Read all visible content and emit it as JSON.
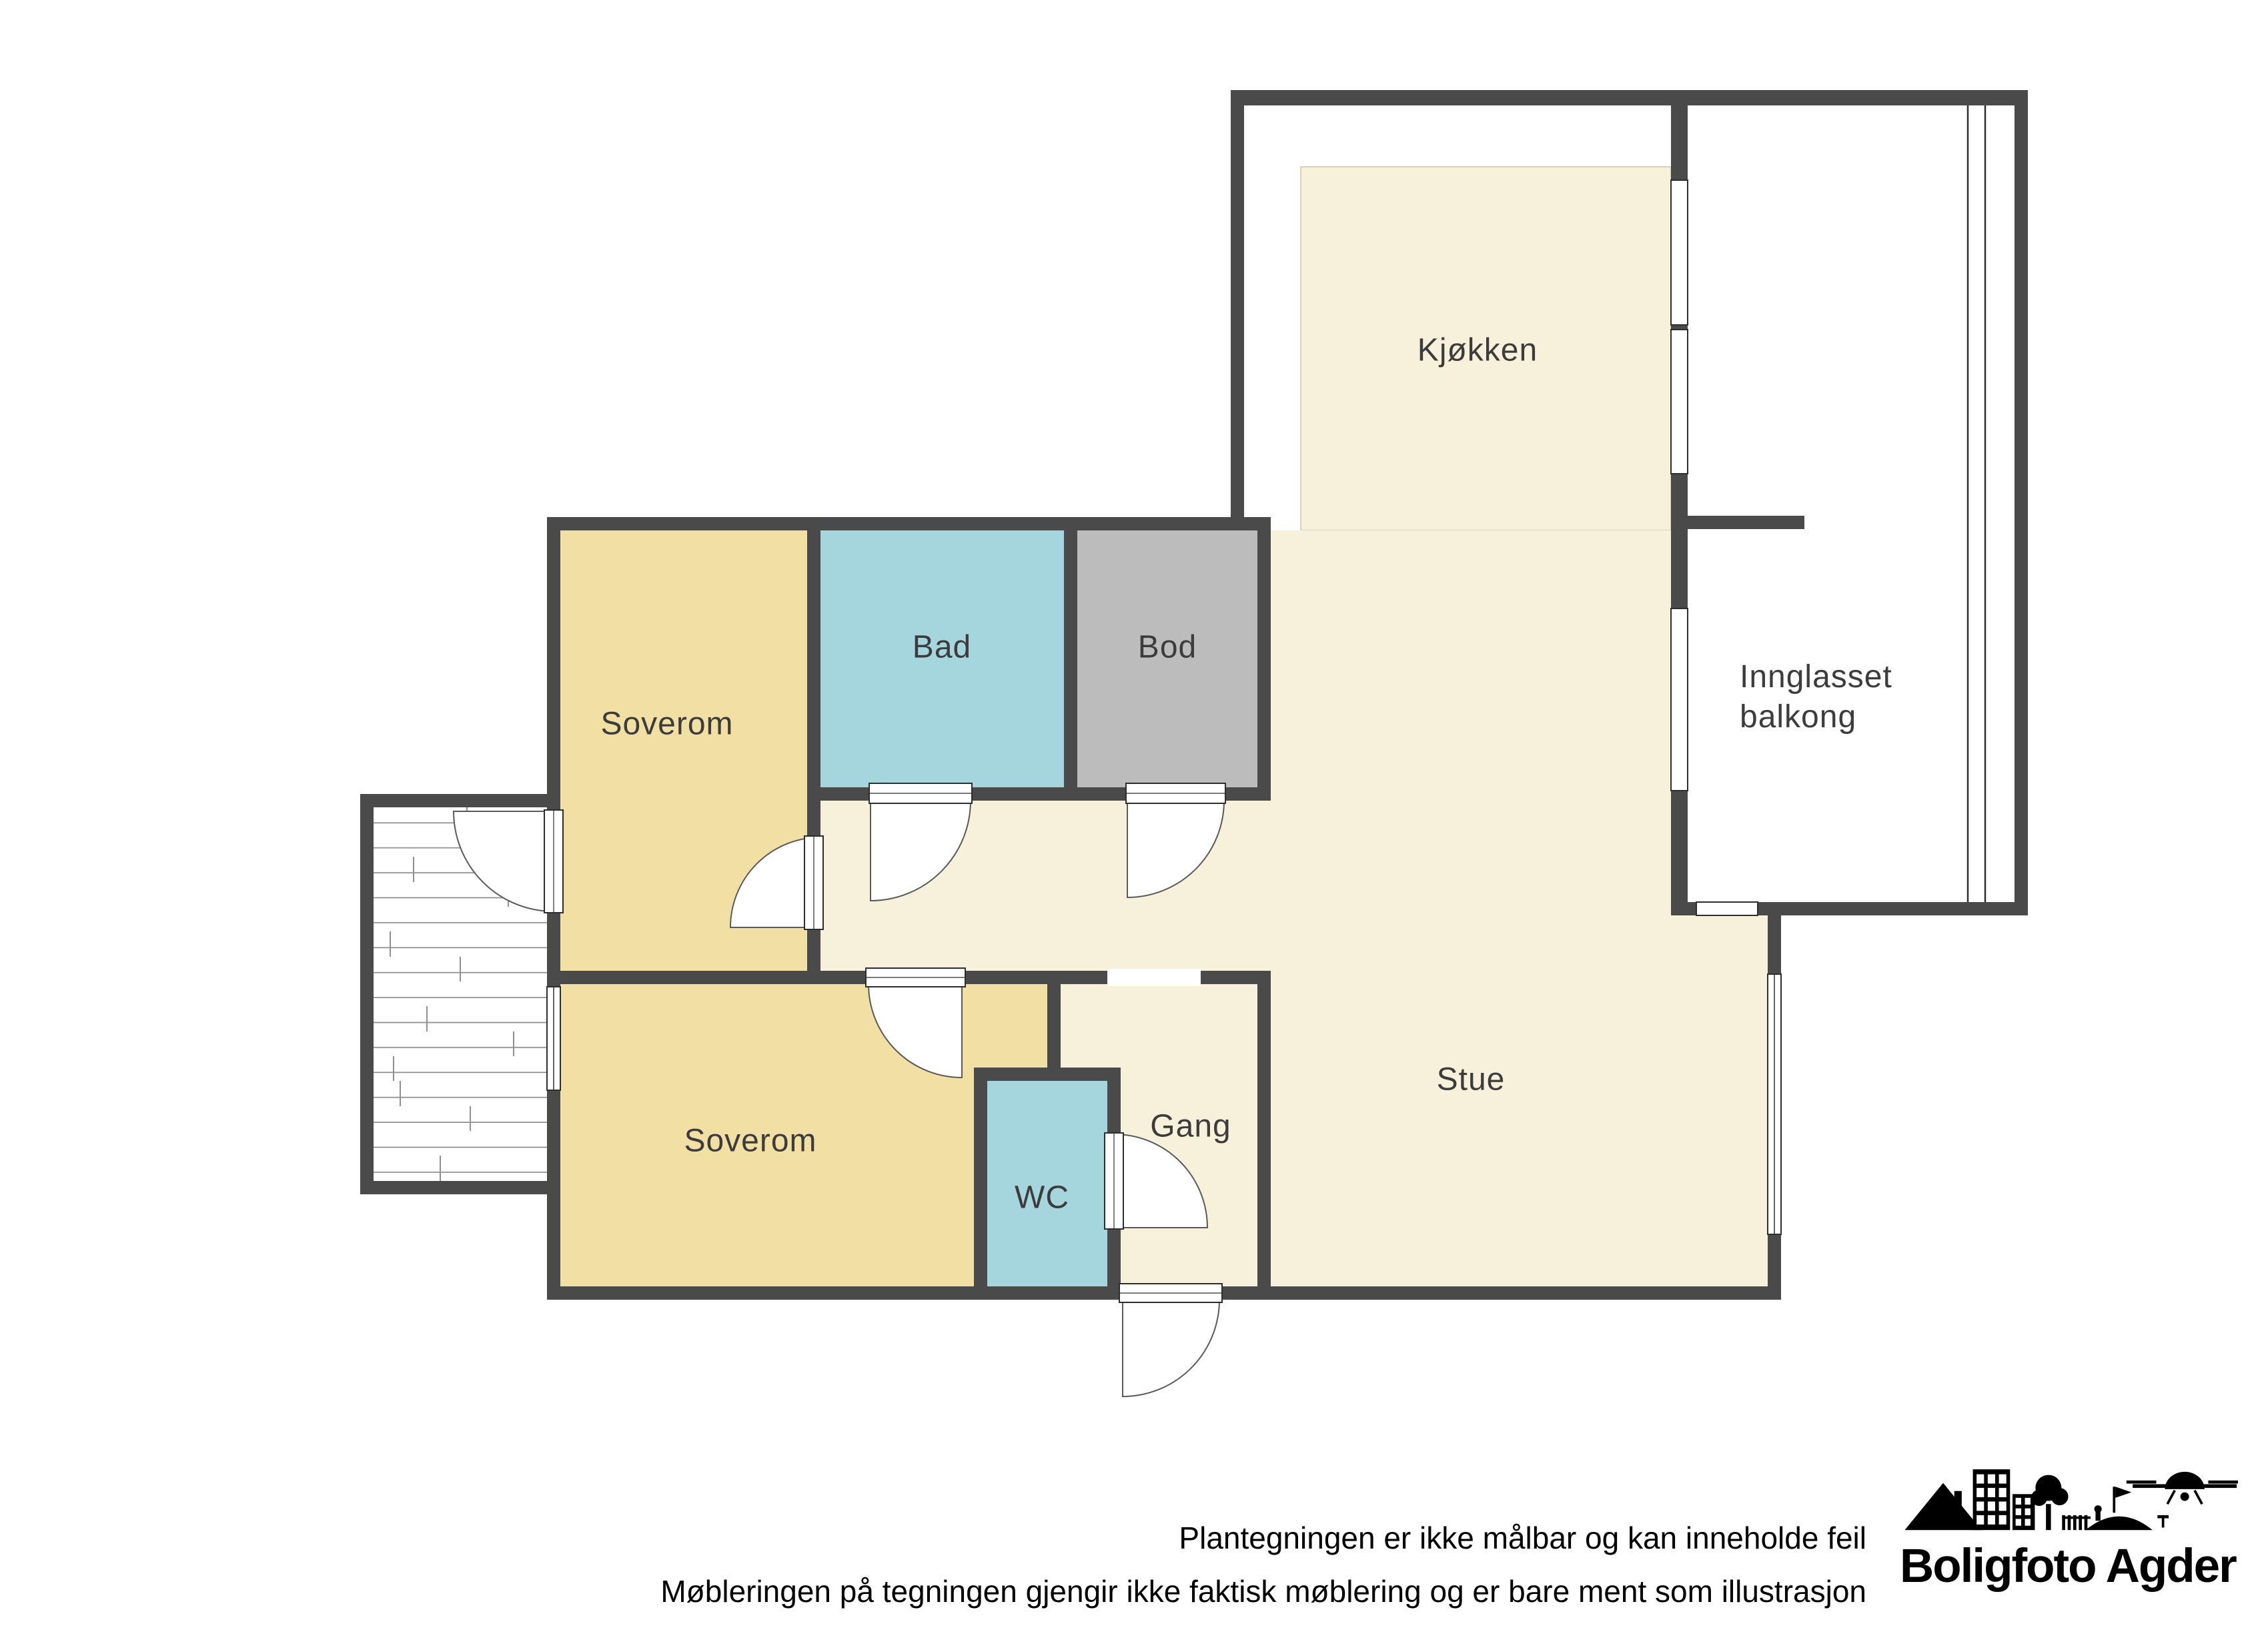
{
  "plan": {
    "title_hint": "apartment floor plan",
    "wall_color": "#4a4a4a",
    "floor_cream": "#f7f1dc",
    "bedroom_yellow": "#f1dfa3",
    "bath_blue": "#a5d6de",
    "storage_gray": "#bcbcbc",
    "rooms": [
      {
        "id": "kjokken",
        "label": "Kjøkken",
        "color": "#f7f1dc"
      },
      {
        "id": "innglasset-balkong",
        "label": "Innglasset balkong",
        "line1": "Innglasset",
        "line2": "balkong",
        "color": "#ffffff"
      },
      {
        "id": "soverom-1",
        "label": "Soverom",
        "color": "#f1dfa3"
      },
      {
        "id": "bad",
        "label": "Bad",
        "color": "#a5d6de"
      },
      {
        "id": "bod",
        "label": "Bod",
        "color": "#bcbcbc"
      },
      {
        "id": "soverom-2",
        "label": "Soverom",
        "color": "#f1dfa3"
      },
      {
        "id": "wc",
        "label": "WC",
        "color": "#a5d6de"
      },
      {
        "id": "gang",
        "label": "Gang",
        "color": "#f7f1dc"
      },
      {
        "id": "stue",
        "label": "Stue",
        "color": "#f7f1dc"
      }
    ]
  },
  "footer": {
    "disclaimer_line1": "Plantegningen er ikke målbar og kan inneholde feil",
    "disclaimer_line2": "Møbleringen på tegningen gjengir ikke faktisk møblering og er bare ment som illustrasjon"
  },
  "logo": {
    "text": "Boligfoto Agder",
    "icons": [
      "mountain-icon",
      "building-icon",
      "tree-icon",
      "fence-icon",
      "hill-flag-icon",
      "drone-icon"
    ]
  }
}
